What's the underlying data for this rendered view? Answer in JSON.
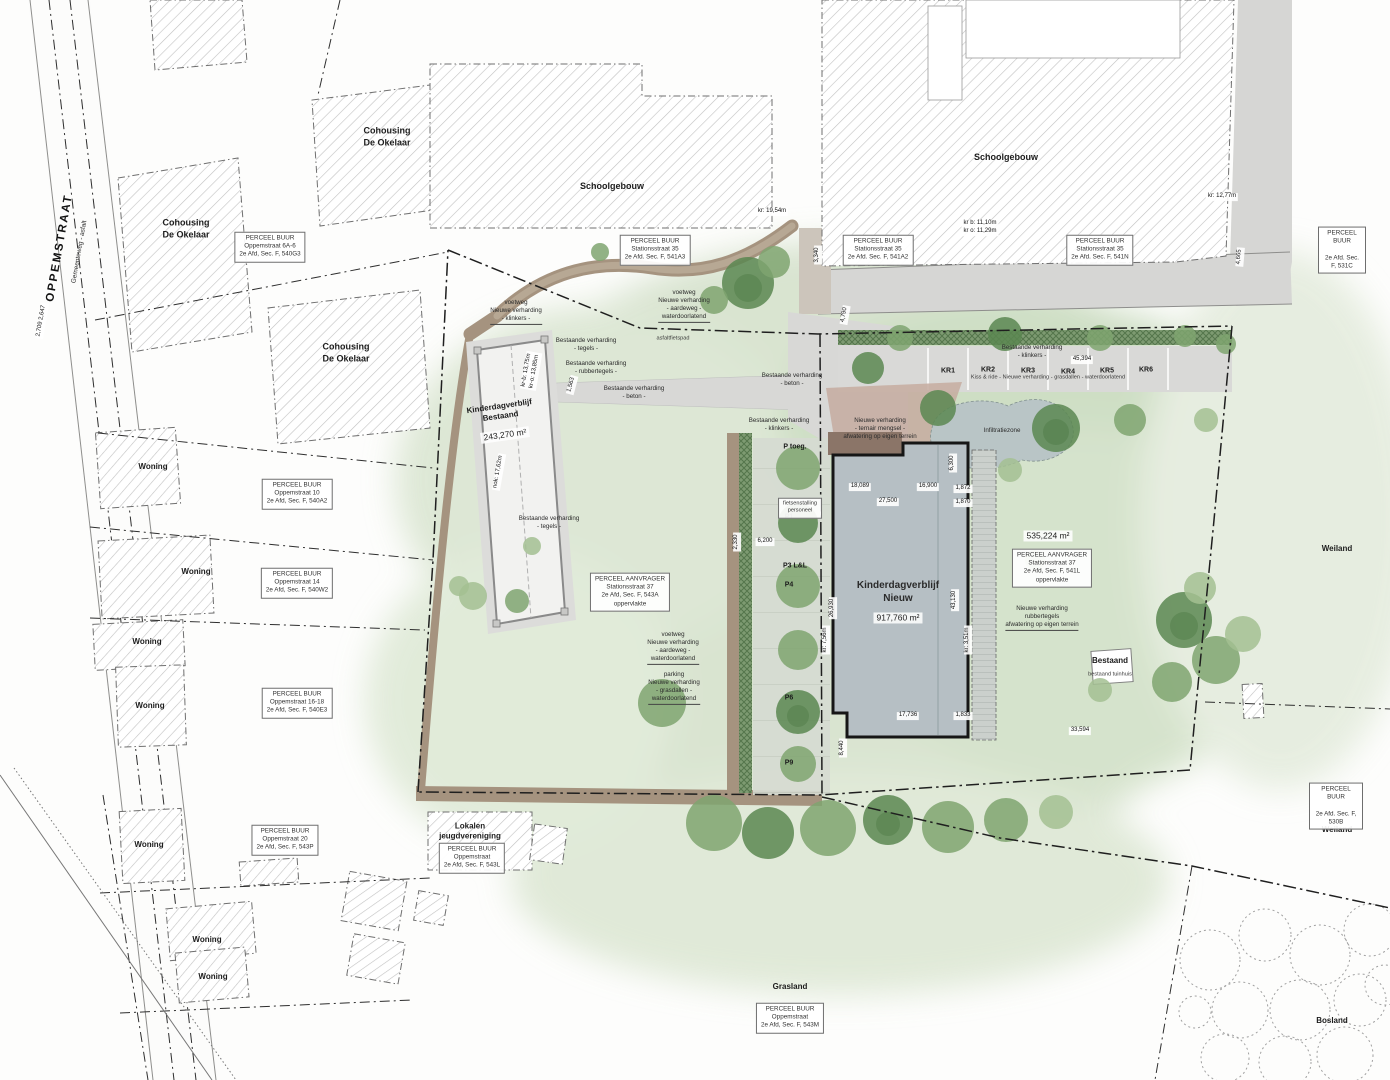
{
  "street": {
    "name": "OPPEMSTRAAT",
    "type": "Gemeenteweg - asfalt",
    "dims": "2,709   2,647"
  },
  "colors": {
    "site_green": "#cfdfc4",
    "road_gray": "#d6d6d4",
    "path_brown": "#a5937f",
    "building_new": "#b6bfc4",
    "water": "#b9c5c6"
  },
  "buildings": {
    "cohousing": "Cohousing\nDe Okelaar",
    "school": "Schoolgebouw",
    "woning": "Woning",
    "kdv_bestaand": "Kinderdagverblijf\nBestaand",
    "kdv_bestaand_area": "243,270 m²",
    "kdv_nieuw": "Kinderdagverblijf\nNieuw",
    "kdv_nieuw_area": "917,760 m²",
    "bestaand": "Bestaand",
    "bestaand_sub": "bestaand tuinhuis",
    "lokalen": "Lokalen\njeugdvereniging"
  },
  "terrain": {
    "weiland": "Weiland",
    "grasland": "Grasland",
    "bosland": "Bosland",
    "site_area": "535,224 m²"
  },
  "parcels": {
    "buur_540g3": "PERCEEL BUUR\nOppemstraat 6A-6\n2e Afd, Sec. F, 540G3",
    "buur_541a3": "PERCEEL BUUR\nStationsstraat 35\n2e Afd. Sec. F, 541A3",
    "buur_541a2": "PERCEEL BUUR\nStationsstraat 35\n2e Afd. Sec. F, 541A2",
    "buur_541n": "PERCEEL BUUR\nStationsstraat 35\n2e Afd. Sec. F, 541N",
    "buur_531c": "PERCEEL BUUR\n\n2e Afd. Sec. F, 531C",
    "buur_540a2": "PERCEEL BUUR\nOppemstraat 10\n2e Afd, Sec. F, 540A2",
    "buur_540w2": "PERCEEL BUUR\nOppemstraat 14\n2e Afd, Sec. F, 540W2",
    "buur_540e3": "PERCEEL BUUR\nOppemstraat 16-18\n2e Afd, Sec. F, 540E3",
    "buur_543p": "PERCEEL BUUR\nOppemstraat 20\n2e Afd, Sec. F, 543P",
    "buur_543l": "PERCEEL BUUR\nOppemstraat\n2e Afd, Sec. F, 543L",
    "buur_543m": "PERCEEL BUUR\nOppemstraat\n2e Afd, Sec. F, 543M",
    "buur_530b": "PERCEEL BUUR\n\n2e Afd. Sec. F, 530B",
    "aanvrager_543a": "PERCEEL AANVRAGER\nStationsstraat 37\n2e Afd, Sec. F, 543A\noppervlakte",
    "aanvrager_541l": "PERCEEL AANVRAGER\nStationsstraat 37\n2e Afd, Sec. F, 541L\noppervlakte"
  },
  "paving": {
    "voetweg_klinkers": "voetweg\nNieuwe verharding\n- klinkers -",
    "voetweg_aardeweg": "voetweg\nNieuwe verharding\n- aardeweg -\nwaterdoorlatend",
    "asfaltfietspad": "asfaltfietspad",
    "best_tegels": "Bestaande verharding\n- tegels -",
    "best_rubbertegels": "Bestaande verharding\n- rubbertegels -",
    "best_beton": "Bestaande verharding\n- beton -",
    "best_klinkers": "Bestaande verharding\n- klinkers -",
    "parking_grasdallen": "parking\nNieuwe verharding\n- grasdallen -\nwaterdoorlatend",
    "ternair": "Nieuwe verharding\n- ternair mengsel -\nafwatering op eigen terrein",
    "rubbertegels_nieuw": "Nieuwe verharding\nrubbertegels\nafwatering op eigen terrein",
    "kiss_ride": "Kiss & ride  -  Nieuwe verharding  -  grasdallen  -  waterdoorlatend",
    "infiltratiezone": "Infiltratiezone"
  },
  "parking": {
    "kr1": "KR1",
    "kr2": "KR2",
    "kr3": "KR3",
    "kr4": "KR4",
    "kr5": "KR5",
    "kr6": "KR6",
    "p_toeg": "P toeg.",
    "p1": "P1",
    "p3": "P3  L&L",
    "p4": "P4",
    "p6": "P6",
    "p9": "P9",
    "fietsenstalling": "fietsenstalling\npersoneel"
  },
  "dims": {
    "d3340": "3,340",
    "d4790": "4,790",
    "d4665": "4,665",
    "kr1277": "kr: 12,77m",
    "krb1110": "kr b: 11,10m\nkr o: 11,29m",
    "kr1954": "kr: 19,54m",
    "d18089": "18,089",
    "d16900": "16,900",
    "d1872": "1,872",
    "d27500": "27,500",
    "d1870": "1,870",
    "d26930": "26,930",
    "kr756": "kr: 7,56m",
    "d43130": "43,130",
    "kr351": "kr: 3,51m",
    "d6300": "6,300",
    "d17736": "17,736",
    "d1833": "1,833",
    "d33594": "33,594",
    "d6200": "6,200",
    "d2330": "2,330",
    "d45394": "45,394",
    "d8440": "8,440",
    "d1563": "1,563",
    "nok1762": "nok: 17,62m",
    "krb1375": "kr-b: 13,75m\nkr-o: 13,85m"
  }
}
